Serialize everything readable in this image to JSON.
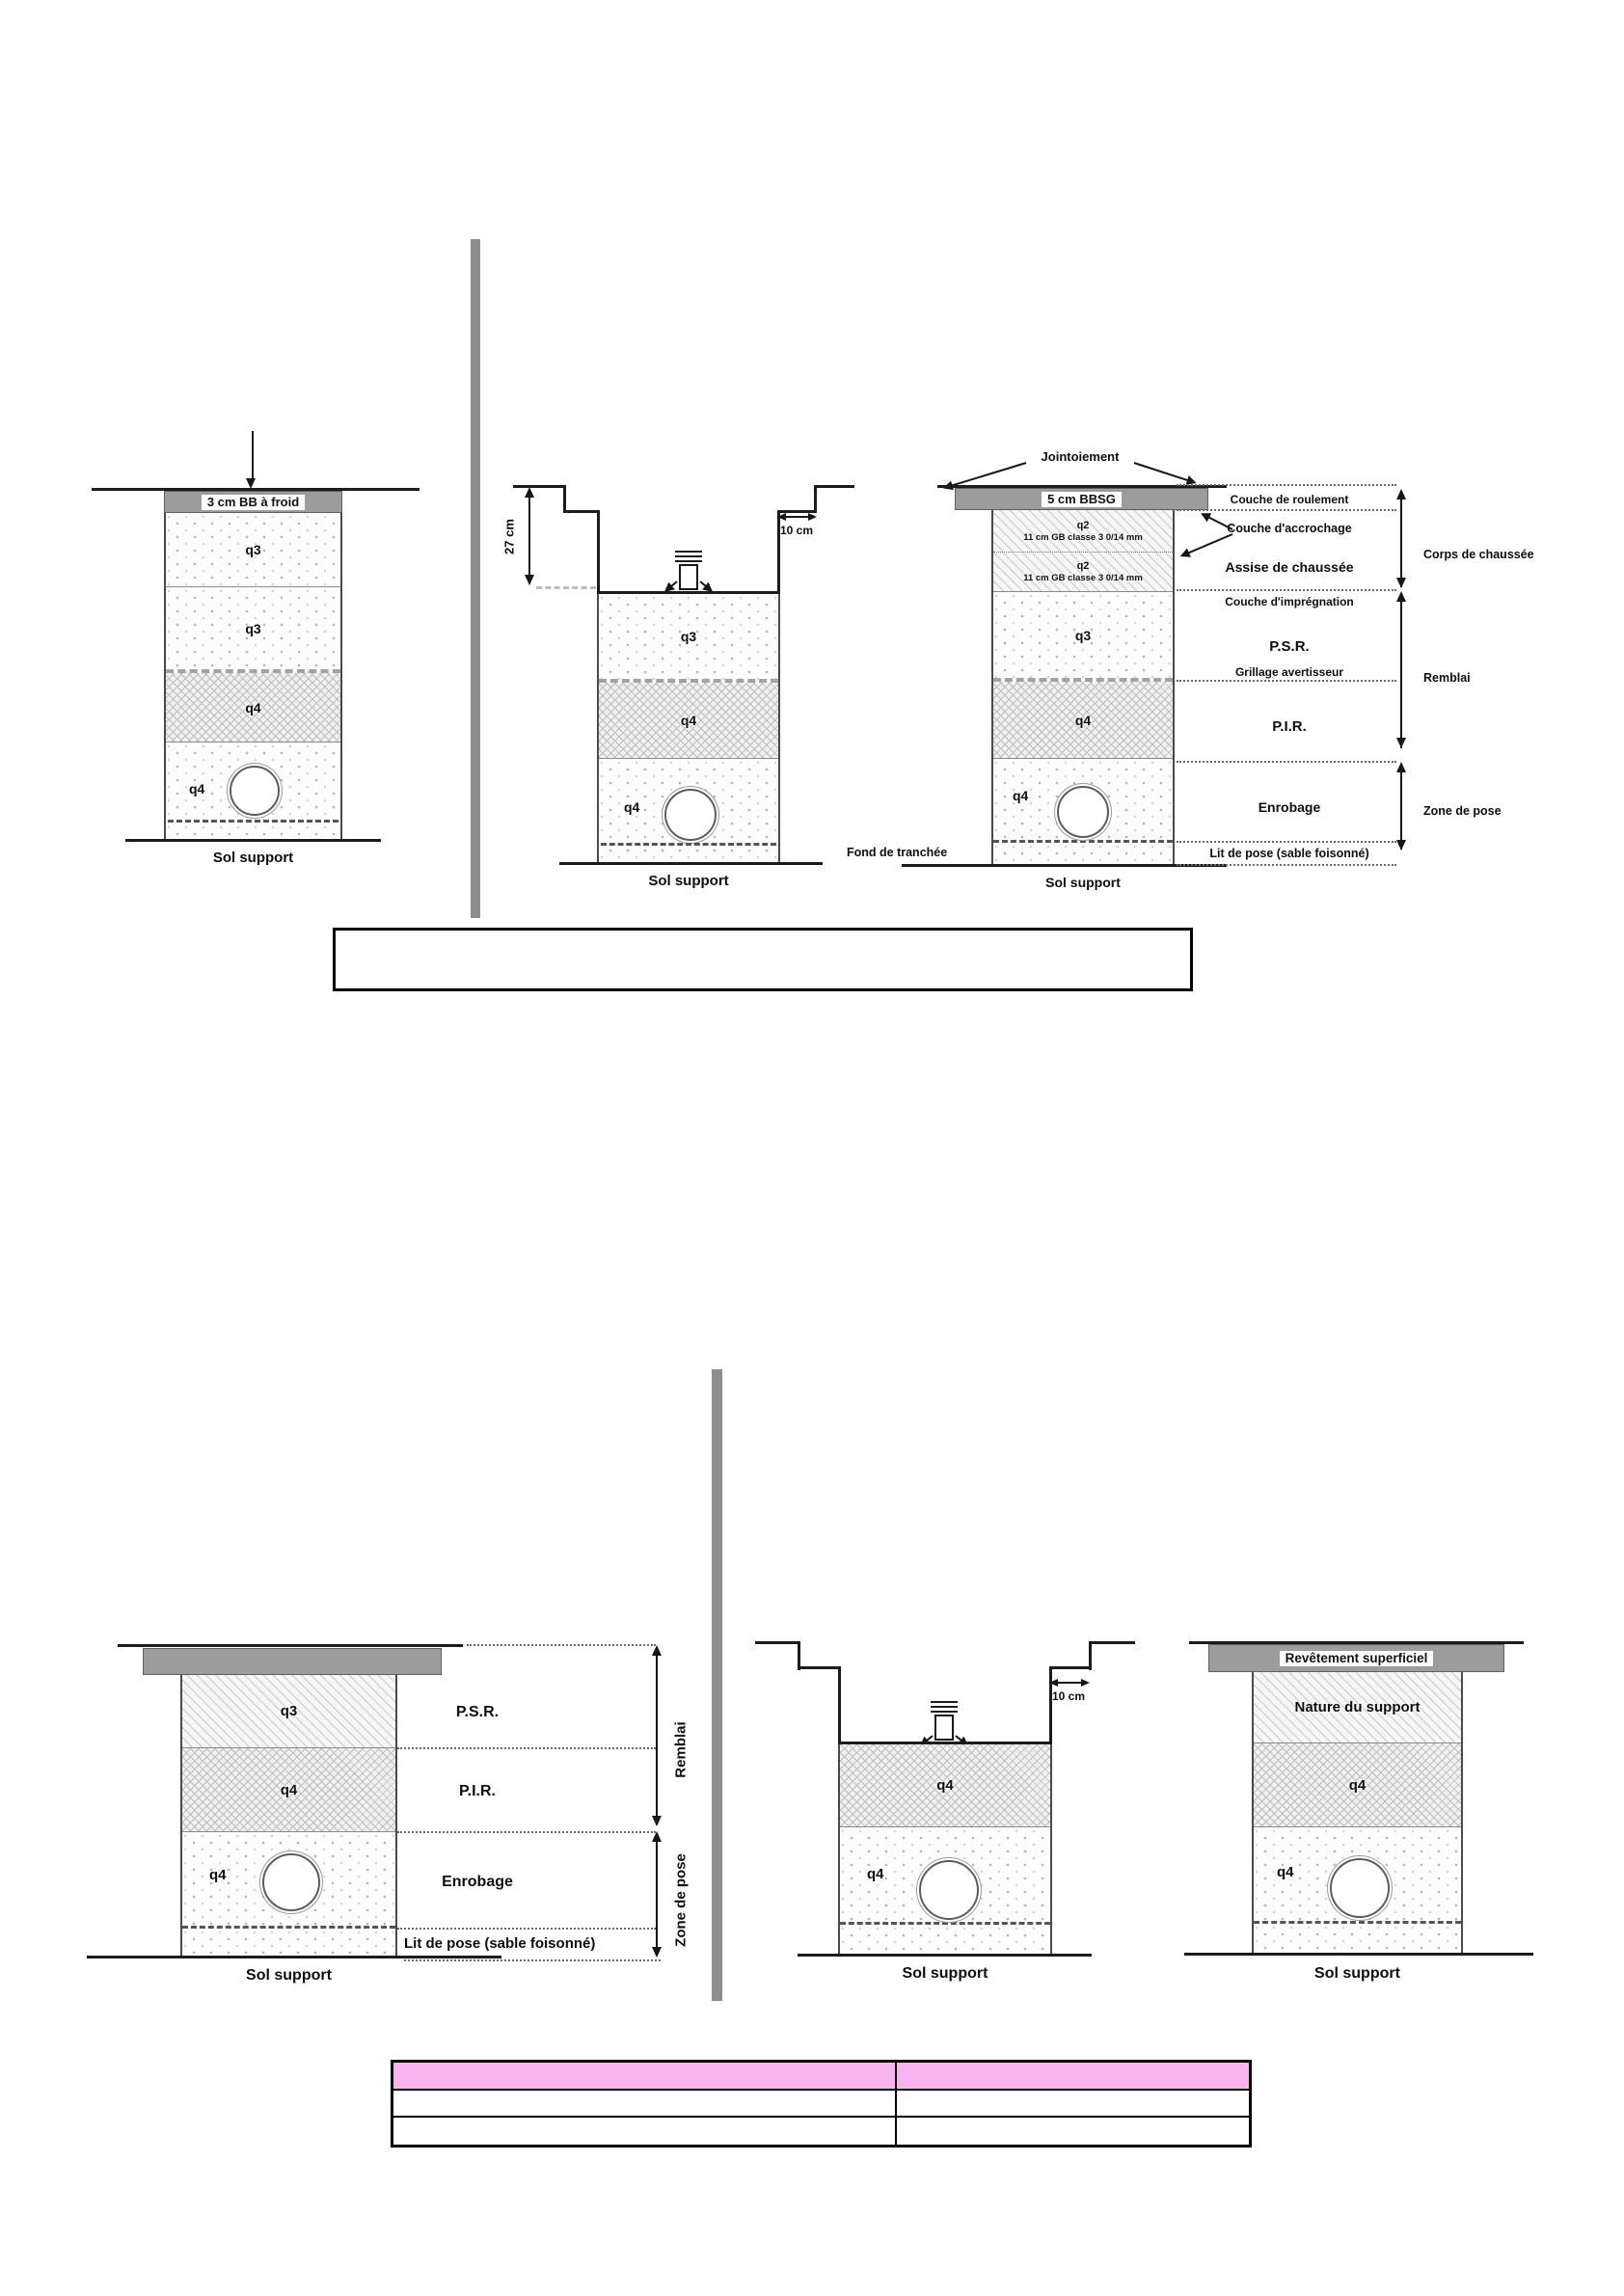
{
  "colors": {
    "header_pink": "#f9b4ef",
    "cap_gray": "#9c9c9c",
    "divider_gray": "#8d8d8d",
    "line_black": "#1c1c1c"
  },
  "labels": {
    "q2": "q2",
    "q3": "q3",
    "q4": "q4",
    "gb_class": "11 cm GB classe 3 0/14 mm",
    "sol": "Sol support"
  },
  "a": {
    "cap": "3 cm BB à froid"
  },
  "b": {
    "dim_v": "27 cm",
    "dim_h": "10 cm"
  },
  "c": {
    "jointoiement": "Jointoiement",
    "cap": "5 cm BBSG",
    "fond": "Fond de tranchée",
    "side": [
      "Couche de roulement",
      "Couche d'accrochage",
      "Assise de chaussée",
      "Couche d'imprégnation",
      "P.S.R.",
      "Grillage avertisseur",
      "P.I.R.",
      "Enrobage",
      "Lit de pose (sable foisonné)"
    ],
    "brackets": [
      "Corps de chaussée",
      "Remblai",
      "Zone de pose"
    ]
  },
  "d": {
    "psr": "P.S.R.",
    "pir": "P.I.R.",
    "enrobage": "Enrobage",
    "lit": "Lit de pose (sable foisonné)",
    "remblai": "Remblai",
    "zone": "Zone de pose"
  },
  "e": {
    "dim_h": "10 cm"
  },
  "f": {
    "cap": "Revêtement superficiel",
    "nature": "Nature du support"
  }
}
